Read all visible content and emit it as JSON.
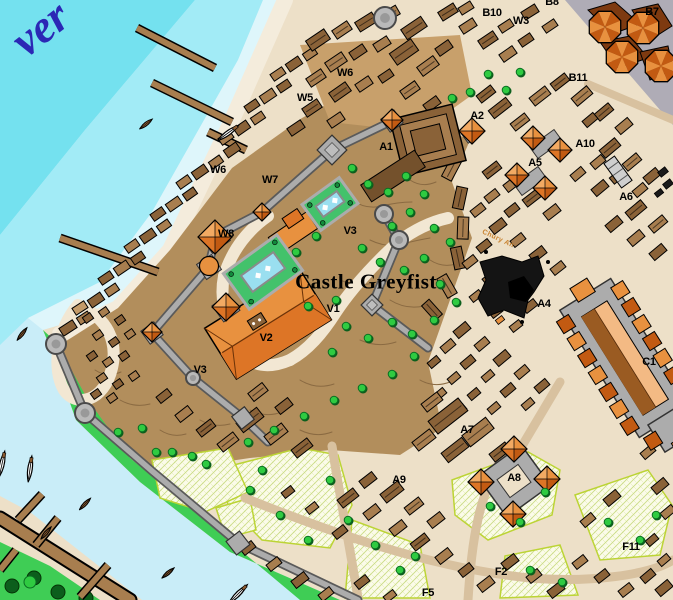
{
  "map": {
    "castle_title": {
      "text": "Castle Greyfist",
      "x": 366,
      "y": 282,
      "rotate": 0
    },
    "river_label": {
      "text": "ver",
      "x": 40,
      "y": 28,
      "rotate": -38
    },
    "street_label": {
      "text": "Chury An",
      "x": 498,
      "y": 239,
      "rotate": 25
    },
    "labels": [
      {
        "text": "B8",
        "x": 552,
        "y": 2
      },
      {
        "text": "B10",
        "x": 492,
        "y": 13
      },
      {
        "text": "W3",
        "x": 521,
        "y": 21
      },
      {
        "text": "B7",
        "x": 652,
        "y": 12
      },
      {
        "text": "B11",
        "x": 578,
        "y": 78
      },
      {
        "text": "W6",
        "x": 345,
        "y": 73
      },
      {
        "text": "W5",
        "x": 305,
        "y": 98
      },
      {
        "text": "W6",
        "x": 218,
        "y": 170
      },
      {
        "text": "W7",
        "x": 270,
        "y": 180
      },
      {
        "text": "W8",
        "x": 226,
        "y": 234
      },
      {
        "text": "A1",
        "x": 386,
        "y": 147
      },
      {
        "text": "A2",
        "x": 477,
        "y": 116
      },
      {
        "text": "A10",
        "x": 585,
        "y": 144
      },
      {
        "text": "A5",
        "x": 535,
        "y": 163
      },
      {
        "text": "A6",
        "x": 626,
        "y": 197
      },
      {
        "text": "A4",
        "x": 544,
        "y": 304
      },
      {
        "text": "V3",
        "x": 350,
        "y": 231
      },
      {
        "text": "V1",
        "x": 333,
        "y": 309
      },
      {
        "text": "V2",
        "x": 266,
        "y": 338
      },
      {
        "text": "V3",
        "x": 200,
        "y": 370
      },
      {
        "text": "C1",
        "x": 649,
        "y": 362
      },
      {
        "text": "A7",
        "x": 467,
        "y": 430
      },
      {
        "text": "A9",
        "x": 399,
        "y": 480
      },
      {
        "text": "A8",
        "x": 514,
        "y": 478
      },
      {
        "text": "F2",
        "x": 501,
        "y": 572
      },
      {
        "text": "F5",
        "x": 428,
        "y": 593
      },
      {
        "text": "F11",
        "x": 631,
        "y": 547
      }
    ],
    "palette": {
      "water_deep": "#74E1EF",
      "water_mid": "#A2EBF6",
      "water_pale": "#DEF6FB",
      "water_base": "#C9EDF8",
      "sand": "#EDE0C8",
      "beach": "#F4ECDC",
      "ground": "#B28E5C",
      "ground_light": "#C8A06B",
      "ground_line": "#8A6A42",
      "lawn": "#3FCD55",
      "bldg_mid": "#A87E4F",
      "bldg_dark": "#8A6238",
      "bldg_light": "#C49B69",
      "bldg_xdark": "#74512C",
      "orange": "#E8913F",
      "orange_light": "#F2AA63",
      "orange_mid": "#DD7526",
      "orange_dark": "#C25A12",
      "peach": "#F3BA84",
      "church_brown": "#9A5B22",
      "wall": "#ACACAC",
      "wall_dark": "#5A5A5A",
      "plaza": "#AFACB6",
      "pool": "#9ADFF0",
      "garden": "#43C26B",
      "field_bg": "#FBFBE9",
      "field_line": "#CBDC86",
      "field_border": "#BCD435",
      "tree": "#2FCB41",
      "tree_dark": "#0A6E22",
      "tree_darkest": "#0C5E1C",
      "dirt": "#D8C19F",
      "cream": "#F2E7D3",
      "black": "#141414",
      "river_text": "#2B28B5",
      "street_text": "#C8822F",
      "boat": "#8A5A30",
      "pier": "#A87E4F",
      "white": "#FFFFFF"
    }
  }
}
